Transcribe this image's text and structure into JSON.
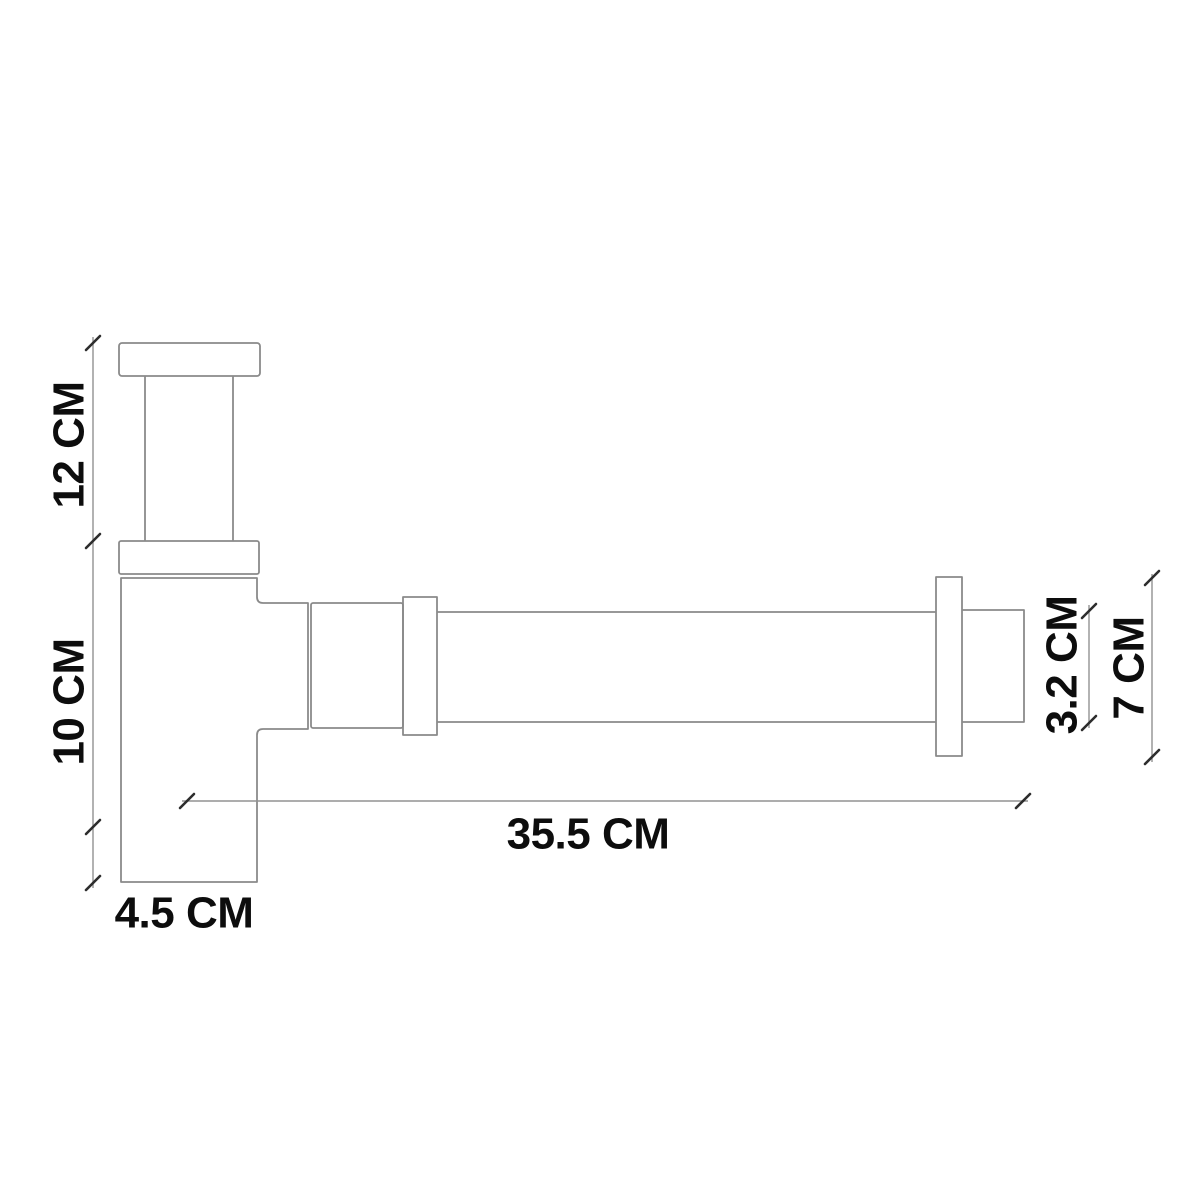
{
  "diagram": {
    "type": "technical-dimension-drawing",
    "description": "Side-view line drawing of a bathroom bottle trap siphon with dimension callouts",
    "labels": {
      "tailpiece_height": "12 CM",
      "body_height": "10 CM",
      "body_width": "4.5 CM",
      "horizontal_length": "35.5 CM",
      "pipe_diameter": "3.2 CM",
      "flange_height": "7 CM"
    },
    "colors": {
      "background": "#ffffff",
      "outline": "#8a8a8a",
      "dimension_line": "#929292",
      "tick": "#2d2d2d",
      "text": "#0d0d0d"
    }
  }
}
